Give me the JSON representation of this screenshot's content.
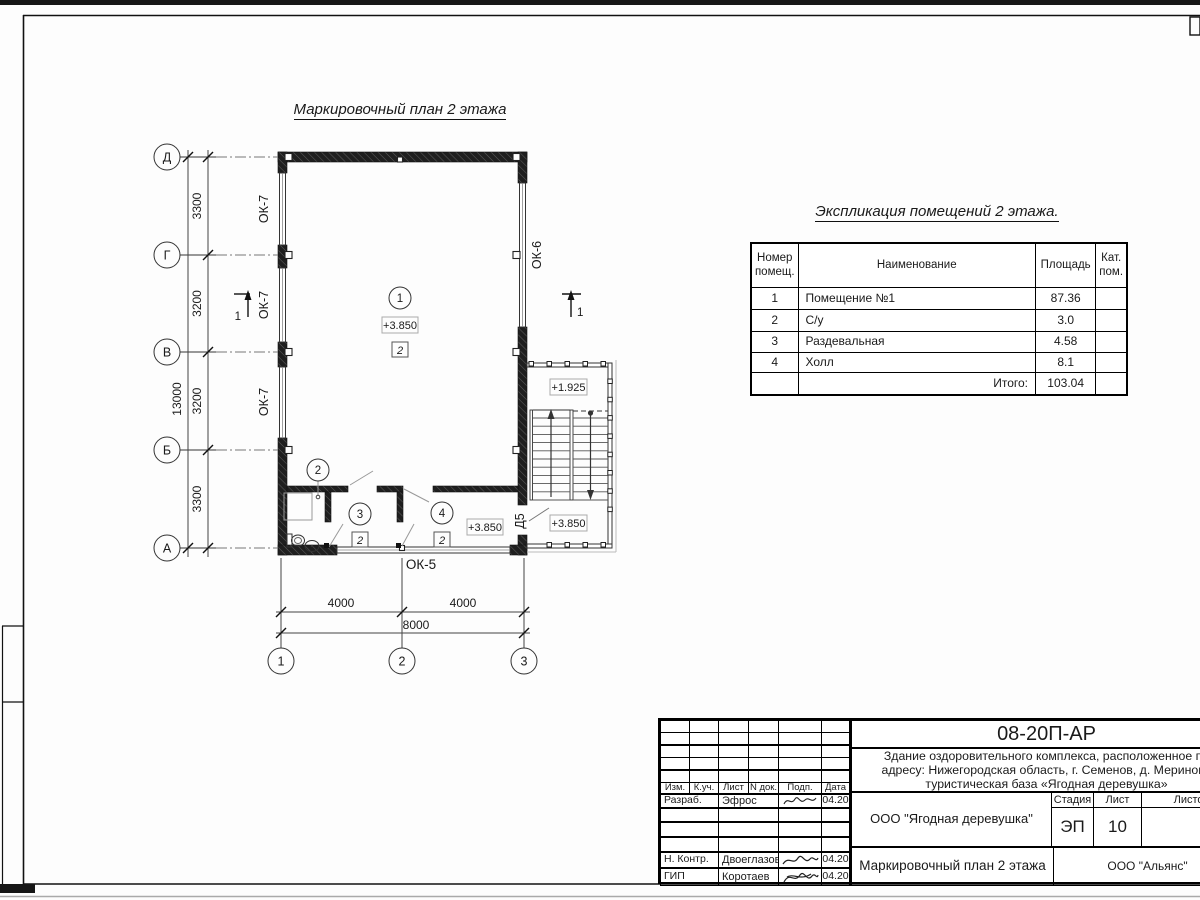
{
  "plan": {
    "title": "Маркировочный план 2 этажа",
    "axes_rows": [
      "Д",
      "Г",
      "В",
      "Б",
      "А"
    ],
    "axes_cols": [
      "1",
      "2",
      "3"
    ],
    "dims_left": [
      "3300",
      "3200",
      "3200",
      "3300"
    ],
    "dim_left_total": "13000",
    "dims_bottom": [
      "4000",
      "4000"
    ],
    "dim_bottom_total": "8000",
    "window_left": "ОК-7",
    "window_right": "ОК-6",
    "window_bottom": "ОК-5",
    "door": "Д5",
    "section_mark": "1",
    "rooms": [
      {
        "num": "1",
        "cat": "2"
      },
      {
        "num": "2"
      },
      {
        "num": "3",
        "cat": "2"
      },
      {
        "num": "4",
        "cat": "2"
      }
    ],
    "elev_room1": "+3.850",
    "elev_hall": "+3.850",
    "elev_stair_upper": "+1.925",
    "elev_stair_lower": "+3.850"
  },
  "explication": {
    "title": "Экспликация помещений 2 этажа.",
    "columns": [
      "Номер помещ.",
      "Наименование",
      "Площадь",
      "Кат. пом."
    ],
    "rows": [
      [
        "1",
        "Помещение №1",
        "87.36"
      ],
      [
        "2",
        "С/у",
        "3.0"
      ],
      [
        "3",
        "Раздевальная",
        "4.58"
      ],
      [
        "4",
        "Холл",
        "8.1"
      ]
    ],
    "total_label": "Итого:",
    "total_value": "103.04"
  },
  "title_block": {
    "doc_number": "08-20П-АР",
    "address_line1": "Здание оздоровительного комплекса, расположенное по",
    "address_line2": "адресу: Нижегородская область, г. Семенов, д. Мериново",
    "address_line3": "туристическая база «Ягодная деревушка»",
    "client": "ООО \"Ягодная деревушка\"",
    "sheet_title": "Маркировочный план 2 этажа",
    "organization": "ООО \"Альянс\"",
    "stage_label": "Стадия",
    "stage": "ЭП",
    "sheet_label": "Лист",
    "sheet_number": "10",
    "sheets_label": "Листов",
    "header_cells": [
      "Изм.",
      "К.уч.",
      "Лист",
      "N док.",
      "Подп.",
      "Дата"
    ],
    "signers": [
      {
        "role": "Разраб.",
        "name": "Эфрос",
        "date": "04.20"
      },
      {
        "role": "Н. Контр.",
        "name": "Двоеглазов",
        "date": "04.20"
      },
      {
        "role": "ГИП",
        "name": "Коротаев",
        "date": "04.20"
      }
    ]
  }
}
